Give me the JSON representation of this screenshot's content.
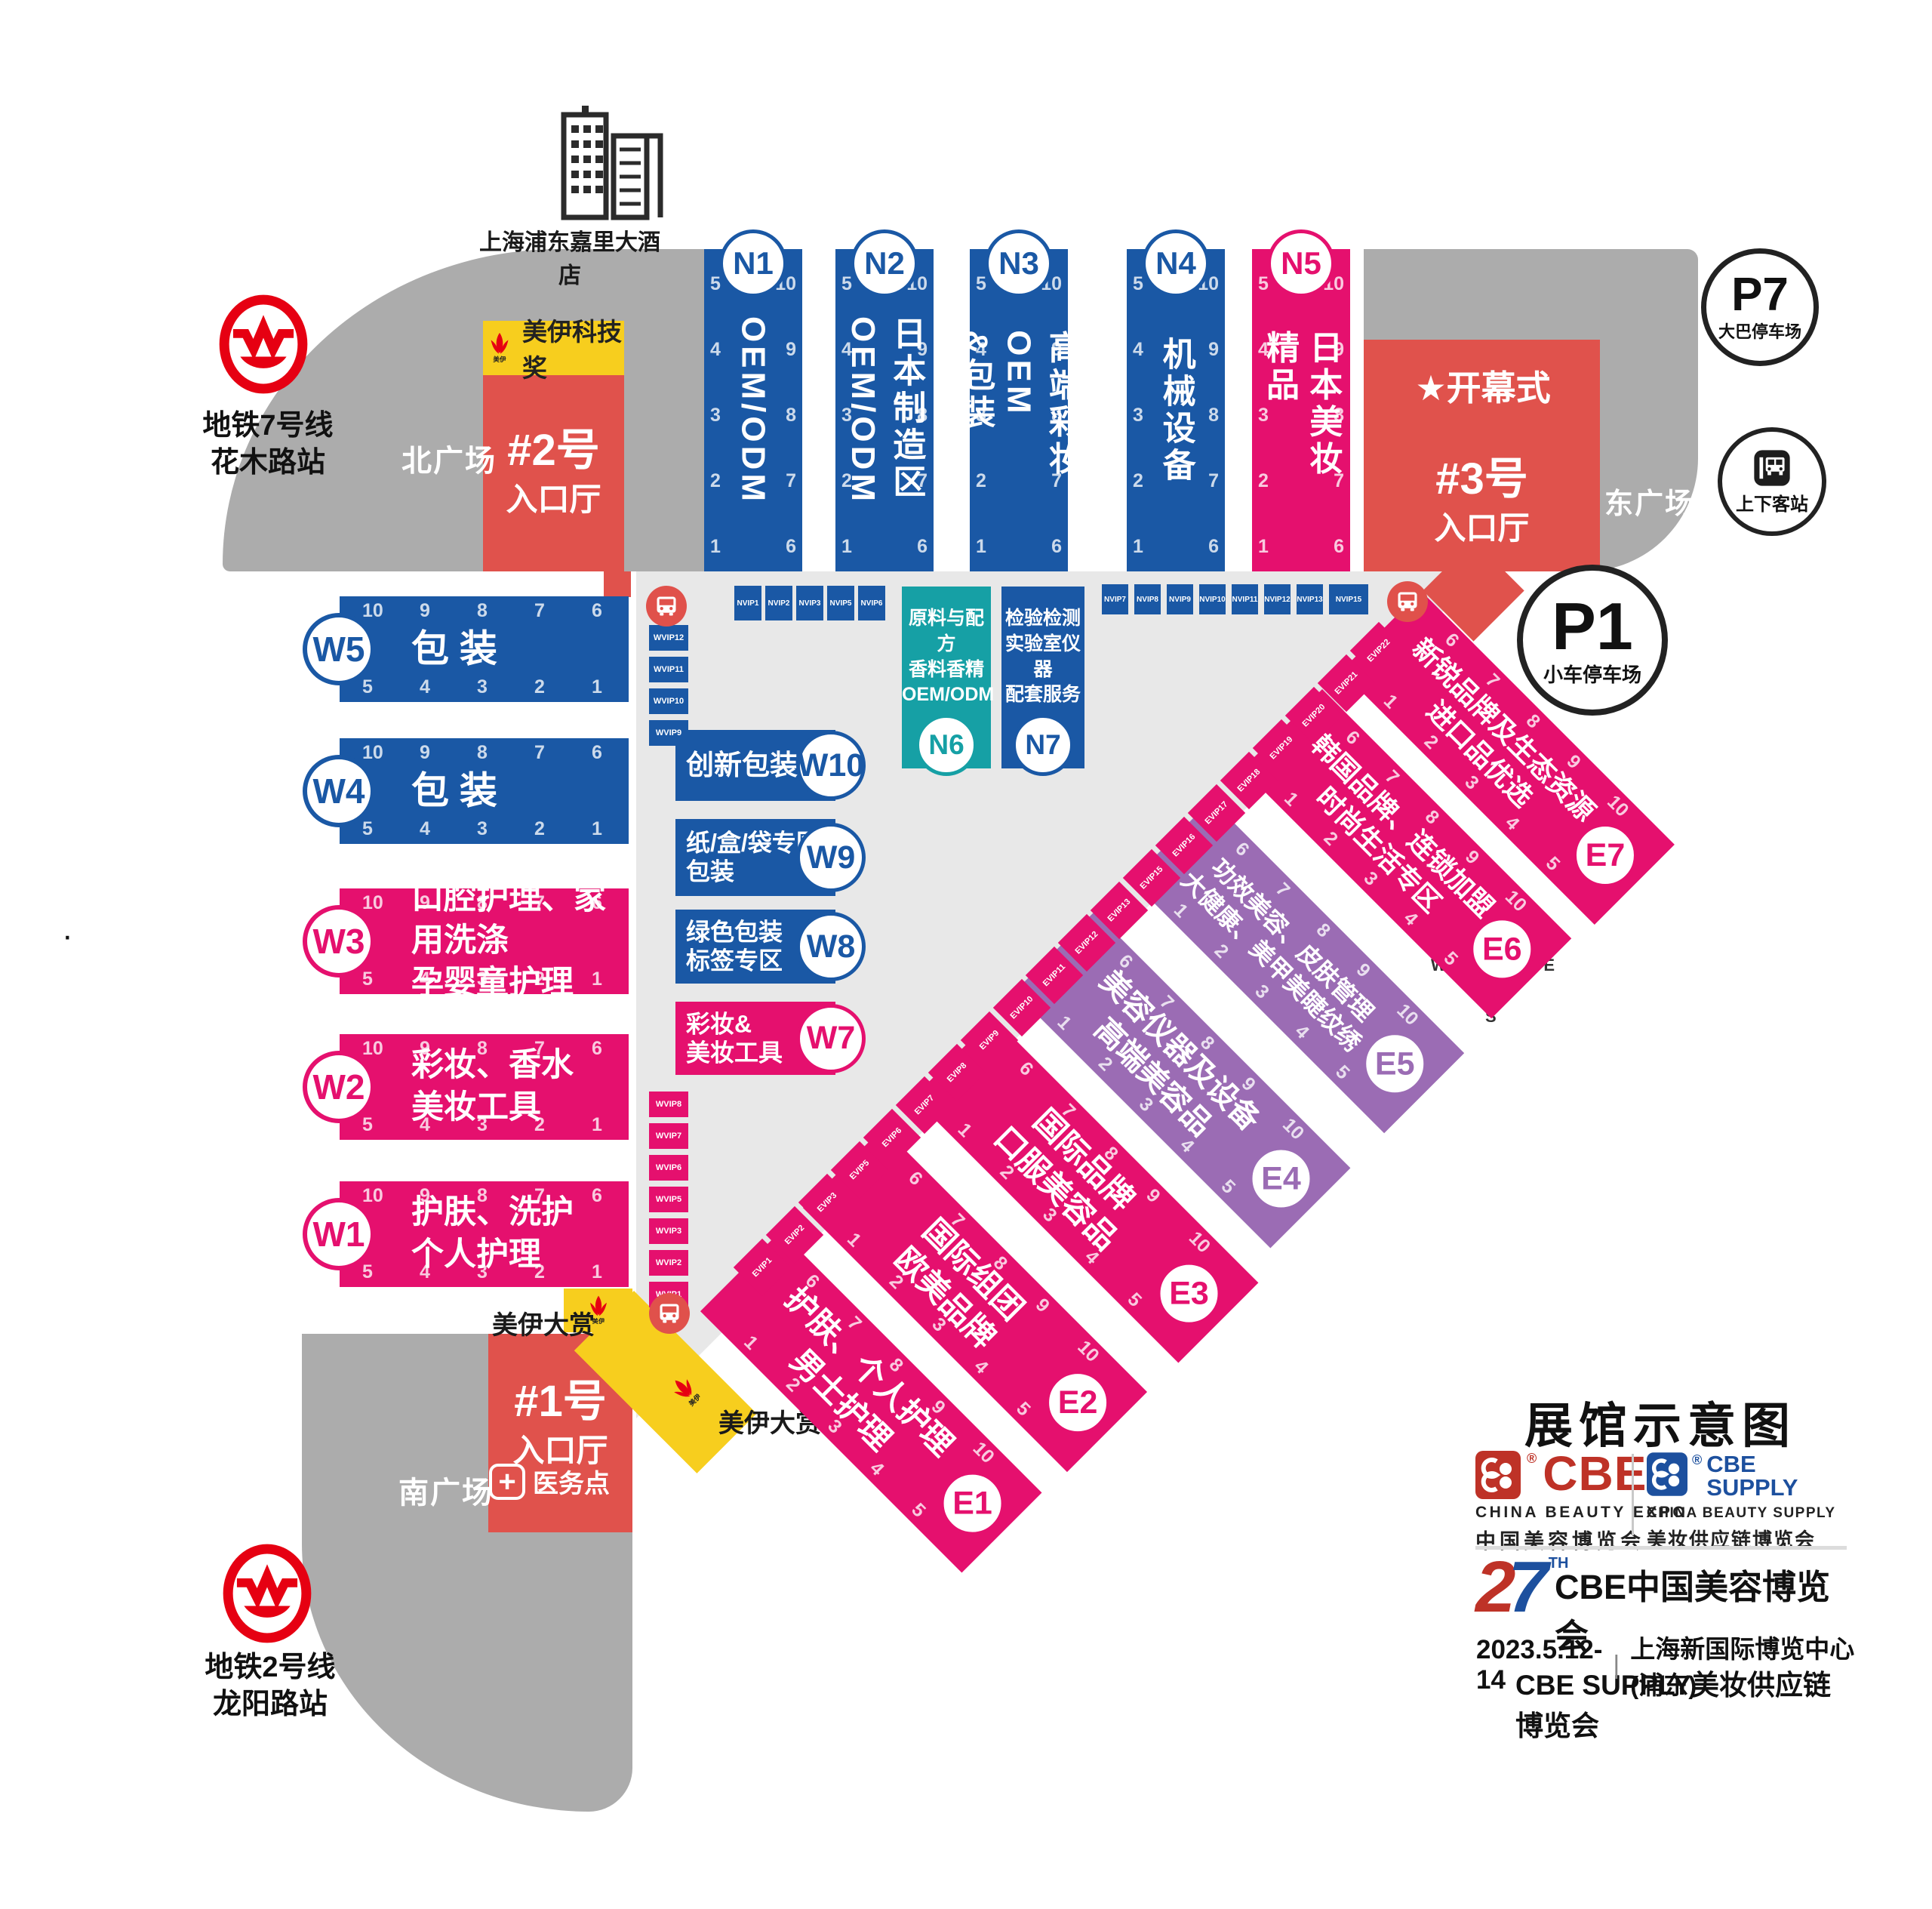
{
  "colors": {
    "blue": "#1A58A5",
    "pink": "#E5106E",
    "purple": "#9B6CB4",
    "teal": "#16A0A5",
    "entrance_red": "#E0524C",
    "bright_red": "#E60012",
    "bus_red": "#E0514B",
    "yellow": "#F7CE1E",
    "plaza_gray": "#ACACAC",
    "concourse_gray": "#E8E8E8",
    "cbe_red": "#BE3227",
    "cbe_blue": "#1D509E"
  },
  "landmarks": {
    "hotel": "上海浦东嘉里大酒店",
    "metro7": [
      "地铁7号线",
      "花木路站"
    ],
    "metro2": [
      "地铁2号线",
      "龙阳路站"
    ],
    "north_plaza": "北广场",
    "south_plaza": "南广场",
    "east_plaza": "东广场",
    "medical": "医务点",
    "meiyi_award": "美伊科技奖",
    "meiyi_logo_text": "美伊",
    "meiyi_grand_1": "美伊大赏",
    "meiyi_grand_2": "美伊大赏",
    "opening": "★开幕式",
    "dot": "·"
  },
  "entrances": {
    "e1": {
      "line1": "#1号",
      "line2": "入口厅"
    },
    "e2": {
      "line1": "#2号",
      "line2": "入口厅"
    },
    "e3": {
      "line1": "#3号",
      "line2": "入口厅"
    }
  },
  "parking": {
    "p7": {
      "code": "P7",
      "label": "大巴停车场"
    },
    "p1": {
      "code": "P1",
      "label": "小车停车场"
    },
    "pickup": {
      "label": "上下客站"
    }
  },
  "gates": {
    "w_top": [
      "10",
      "9",
      "8",
      "7",
      "6"
    ],
    "w_bottom": [
      "5",
      "4",
      "3",
      "2",
      "1"
    ],
    "n_left": [
      "5",
      "4",
      "3",
      "2",
      "1"
    ],
    "n_right": [
      "10",
      "9",
      "8",
      "7",
      "6"
    ],
    "e_top": [
      "6",
      "7",
      "8",
      "9",
      "10"
    ],
    "e_bottom": [
      "1",
      "2",
      "3",
      "4",
      "5"
    ]
  },
  "halls": {
    "n_bars": [
      {
        "id": "N1",
        "vlines": [
          "OEM/ODM"
        ],
        "color": "blue"
      },
      {
        "id": "N2",
        "vlines": [
          "日本制造区",
          "OEM/ODM"
        ],
        "color": "blue"
      },
      {
        "id": "N3",
        "vlines": [
          "高端彩妆OEM",
          "&包装"
        ],
        "color": "blue"
      },
      {
        "id": "N4",
        "vlines": [
          "机械设备"
        ],
        "color": "blue"
      },
      {
        "id": "N5",
        "vlines": [
          "日本美妆精品"
        ],
        "color": "pink"
      }
    ],
    "w_bars": [
      {
        "id": "W5",
        "lines": [
          "包 装"
        ],
        "color": "blue"
      },
      {
        "id": "W4",
        "lines": [
          "包 装"
        ],
        "color": "blue"
      },
      {
        "id": "W3",
        "lines": [
          "口腔护理、家用洗涤",
          "孕婴童护理"
        ],
        "color": "pink"
      },
      {
        "id": "W2",
        "lines": [
          "彩妆、香水",
          "美妆工具"
        ],
        "color": "pink"
      },
      {
        "id": "W1",
        "lines": [
          "护肤、洗护",
          "个人护理"
        ],
        "color": "pink"
      }
    ],
    "w_boxes": [
      {
        "id": "W10",
        "lines": [
          "创新包装"
        ],
        "color": "blue"
      },
      {
        "id": "W9",
        "lines": [
          "纸/盒/袋专区",
          "包装"
        ],
        "color": "blue"
      },
      {
        "id": "W8",
        "lines": [
          "绿色包装",
          "标签专区"
        ],
        "color": "blue"
      },
      {
        "id": "W7",
        "lines": [
          "彩妆&",
          "美妆工具"
        ],
        "color": "pink"
      }
    ],
    "n_boxes": [
      {
        "id": "N6",
        "lines": [
          "原料与配方",
          "香料香精",
          "OEM/ODM"
        ],
        "color": "teal"
      },
      {
        "id": "N7",
        "lines": [
          "检验检测",
          "实验室仪器",
          "配套服务"
        ],
        "color": "blue"
      }
    ],
    "e_bands": [
      {
        "id": "E1",
        "lines": [
          "护肤、个人护理",
          "男士护理"
        ],
        "color": "pink"
      },
      {
        "id": "E2",
        "lines": [
          "国际组团",
          "欧美品牌"
        ],
        "color": "pink"
      },
      {
        "id": "E3",
        "lines": [
          "国际品牌",
          "口服美容品"
        ],
        "color": "pink"
      },
      {
        "id": "E4",
        "lines": [
          "美容仪器及设备",
          "高端美容品"
        ],
        "color": "purple"
      },
      {
        "id": "E5",
        "lines": [
          "功效美容、皮肤管理",
          "大健康、美甲美睫纹绣"
        ],
        "color": "purple"
      },
      {
        "id": "E6",
        "lines": [
          "韩国品牌、连锁加盟",
          "时尚生活专区"
        ],
        "color": "pink"
      },
      {
        "id": "E7",
        "lines": [
          "新锐品牌及生态资源",
          "进口品优选"
        ],
        "color": "pink"
      }
    ]
  },
  "vip": {
    "nvip_left": [
      "NVIP1",
      "NVIP2",
      "NVIP3",
      "NVIP5",
      "NVIP6"
    ],
    "nvip_right": [
      "NVIP7",
      "NVIP8",
      "NVIP9",
      "NVIP10",
      "NVIP11",
      "NVIP12",
      "NVIP13",
      "NVIP15"
    ],
    "wvip_top": [
      "WVIP12",
      "WVIP11",
      "WVIP10",
      "WVIP9"
    ],
    "wvip_bottom": [
      "WVIP8",
      "WVIP7",
      "WVIP6",
      "WVIP5",
      "WVIP3",
      "WVIP2",
      "WVIP1"
    ],
    "evip": [
      "EVIP1",
      "EVIP2",
      "EVIP3",
      "EVIP5",
      "EVIP6",
      "EVIP7",
      "EVIP8",
      "EVIP9",
      "EVIP10",
      "EVIP11",
      "EVIP12",
      "EVIP13",
      "EVIP15",
      "EVIP16",
      "EVIP17",
      "EVIP18",
      "EVIP19",
      "EVIP20",
      "EVIP21",
      "EVIP22"
    ]
  },
  "compass": {
    "n": "N",
    "e": "E",
    "s": "S",
    "w": "W"
  },
  "footer": {
    "map_title": "展馆示意图",
    "cbe": {
      "logo": "CBE",
      "reg": "®",
      "line1": "CHINA BEAUTY EXPO",
      "line2": "中国美容博览会"
    },
    "supply": {
      "logo1": "CBE",
      "logo2": "SUPPLY",
      "reg": "®",
      "line1": "CHINA BEAUTY SUPPLY",
      "line2": "美妆供应链博览会"
    },
    "edition": {
      "num2": "2",
      "num7": "7",
      "sup": "TH",
      "line1": "CBE中国美容博览会",
      "line2": "CBE SUPPLY美妆供应链博览会"
    },
    "date": "2023.5.12-14",
    "bar": "|",
    "venue": "上海新国际博览中心(浦东)"
  }
}
